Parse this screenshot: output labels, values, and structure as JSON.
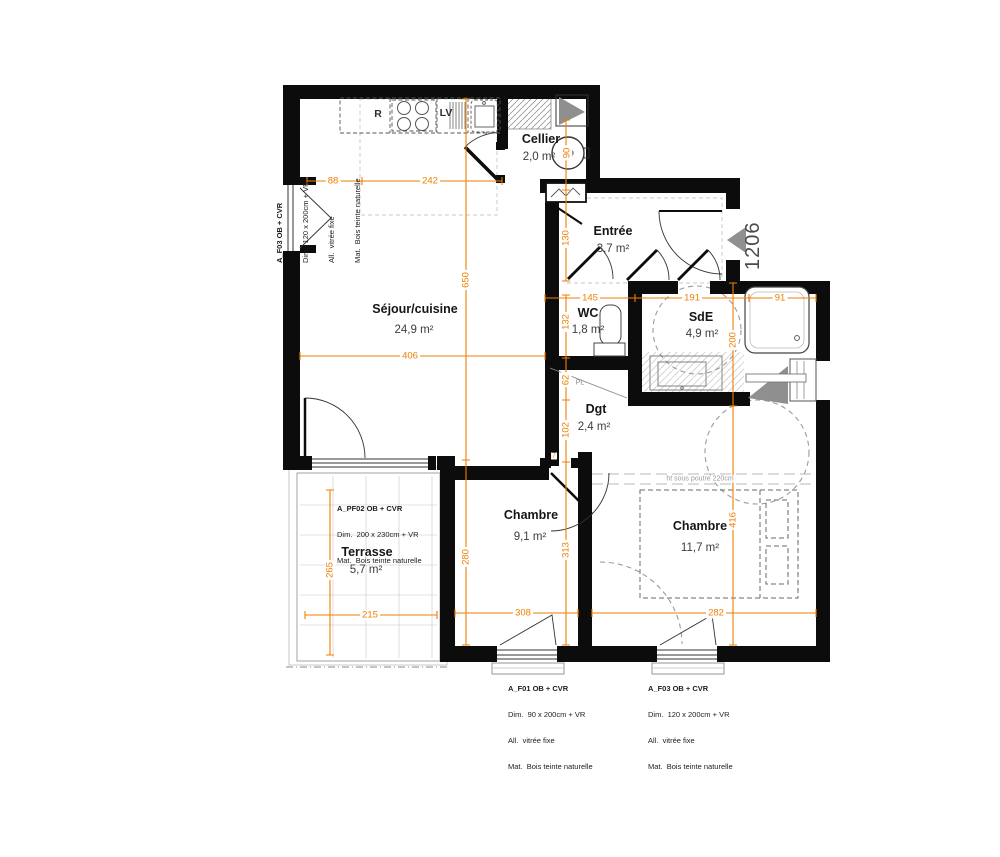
{
  "meta": {
    "unit_number": "1206"
  },
  "rooms": {
    "sejour": {
      "name": "Séjour/cuisine",
      "area": "24,9 m²"
    },
    "cellier": {
      "name": "Cellier",
      "area": "2,0 m²"
    },
    "entree": {
      "name": "Entrée",
      "area": "3,7 m²"
    },
    "wc": {
      "name": "WC",
      "area": "1,8 m²"
    },
    "sde": {
      "name": "SdE",
      "area": "4,9 m²"
    },
    "dgt": {
      "name": "Dgt",
      "area": "2,4 m²"
    },
    "chambre1": {
      "name": "Chambre",
      "area": "9,1 m²"
    },
    "chambre2": {
      "name": "Chambre",
      "area": "11,7 m²"
    },
    "terrasse": {
      "name": "Terrasse",
      "area": "5,7 m²"
    }
  },
  "labels": {
    "fridge": "R",
    "dishwasher": "LV",
    "placard": "PL",
    "beam_note": "ht sous poutre 220cm"
  },
  "dims": {
    "d88": "88",
    "d242": "242",
    "d90": "90",
    "d130": "130",
    "d145": "145",
    "d191": "191",
    "d91": "91",
    "d132": "132",
    "d200": "200",
    "d406": "406",
    "d62": "62",
    "d102": "102",
    "d650": "650",
    "d280": "280",
    "d313": "313",
    "d416": "416",
    "d265": "265",
    "d215": "215",
    "d308": "308",
    "d282": "282",
    "d7": "7"
  },
  "annotations": {
    "left_window": {
      "title": "A_F03 OB + CVR",
      "dim": "Dim.  120 x 200cm + VR",
      "allege": "All.  vitrée fixe",
      "mat": "Mat.  Bois teinte naturelle"
    },
    "terrace_window": {
      "title": "A_PF02 OB + CVR",
      "dim": "Dim.  200 x 230cm + VR",
      "mat": "Mat.  Bois teinte naturelle"
    },
    "bedroom1_window": {
      "title": "A_F01 OB + CVR",
      "dim": "Dim.  90 x 200cm + VR",
      "allege": "All.  vitrée fixe",
      "mat": "Mat.  Bois teinte naturelle"
    },
    "bedroom2_window": {
      "title": "A_F03 OB + CVR",
      "dim": "Dim.  120 x 200cm + VR",
      "allege": "All.  vitrée fixe",
      "mat": "Mat.  Bois teinte naturelle"
    }
  },
  "colors": {
    "wall": "#0c0c0c",
    "dimension": "#ee7f00",
    "shadow_gray": "#8f8f8f"
  }
}
